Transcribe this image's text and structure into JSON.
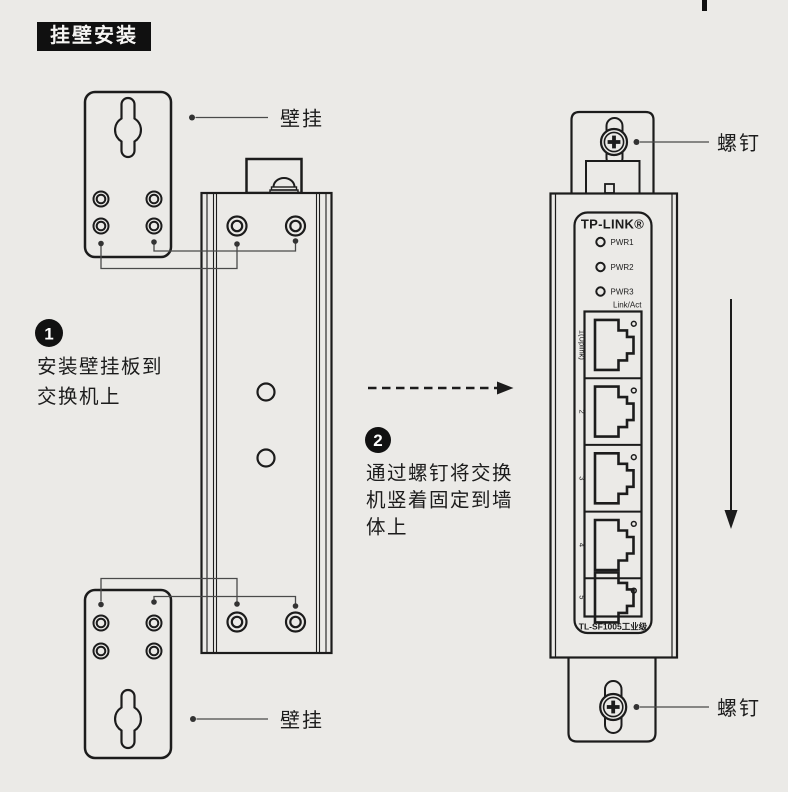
{
  "header": {
    "title": "挂壁安装"
  },
  "annotations": {
    "wall_plate_top": "壁挂",
    "wall_plate_bottom": "壁挂",
    "screw_top": "螺钉",
    "screw_bottom": "螺钉"
  },
  "steps": [
    {
      "num": "1",
      "lines": [
        "安装壁挂板到",
        "交换机上"
      ]
    },
    {
      "num": "2",
      "lines": [
        "通过螺钉将交换",
        "机竖着固定到墙",
        "体上"
      ]
    }
  ],
  "device": {
    "brand": "TP-LINK®",
    "led_labels": [
      "PWR1",
      "PWR2",
      "PWR3"
    ],
    "link_act_label": "Link/Act",
    "port_labels": [
      "1(Uplink)",
      "2",
      "3",
      "4",
      "5"
    ],
    "model_label": "TL-SF1005工业级"
  },
  "colors": {
    "background": "#ebeae7",
    "ink": "#1c1c1c",
    "leader": "#4a4a4a"
  }
}
